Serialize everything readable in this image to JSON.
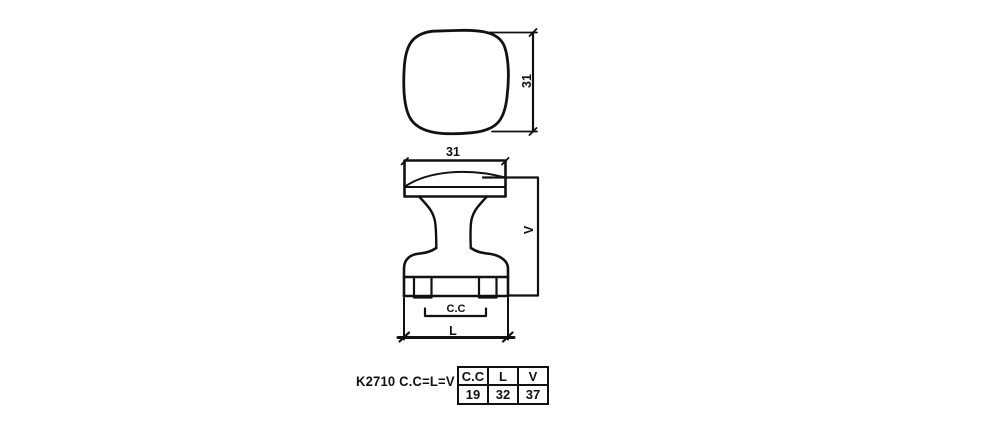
{
  "drawing": {
    "top_view": {
      "width_dim": "31"
    },
    "side_view": {
      "width_dim": "31",
      "height_dim": "V",
      "center_to_center_dim": "C.C",
      "length_dim": "L"
    }
  },
  "label": {
    "model": "K2710 C.C=L=V"
  },
  "table": {
    "headers": [
      "C.C",
      "L",
      "V"
    ],
    "values": [
      "19",
      "32",
      "37"
    ]
  },
  "colors": {
    "line": "#111111",
    "background": "#ffffff"
  }
}
